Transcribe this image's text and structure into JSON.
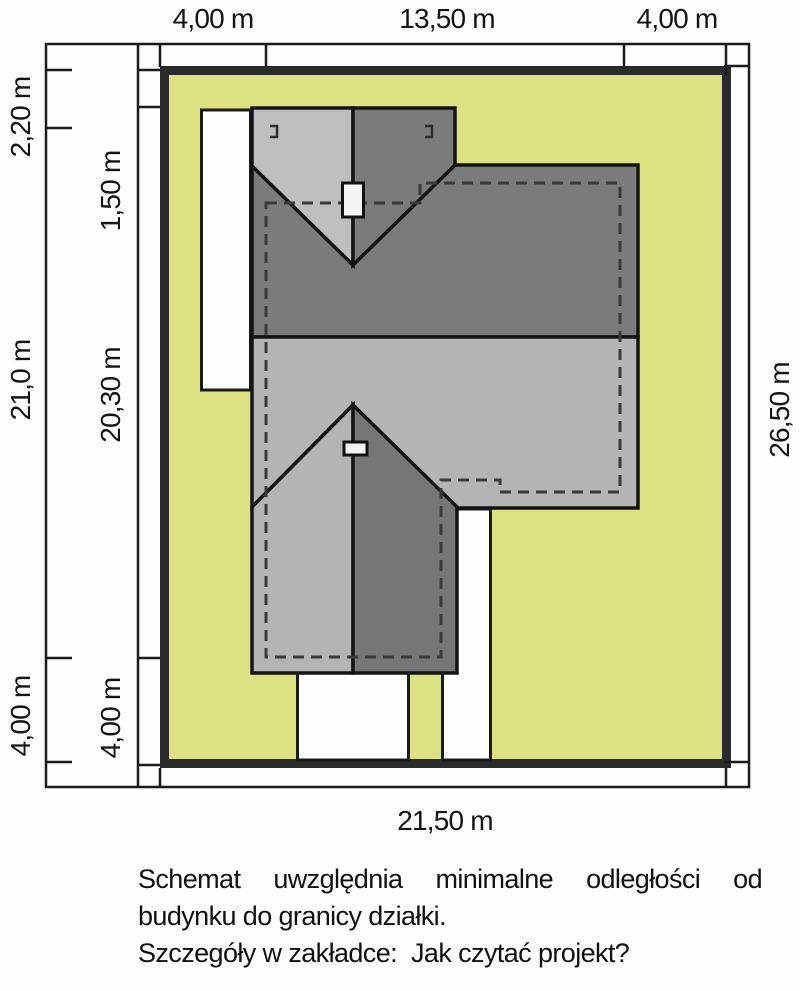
{
  "figure": {
    "type": "site-plan-schematic",
    "dimensions": {
      "top": [
        "4,00 m",
        "13,50 m",
        "4,00 m"
      ],
      "left_outer": [
        "2,20 m",
        "21,0 m",
        "4,00 m"
      ],
      "left_inner": [
        "1,50 m",
        "20,30 m",
        "4,00 m"
      ],
      "right": "26,50 m",
      "bottom": "21,50 m"
    },
    "note": {
      "line1": "Schemat uwzględnia minimalne odległości od",
      "line2": "budynku do granicy działki.",
      "line3_prefix": "Szczegóły w zakładce:",
      "line3_suffix": "Jak czytać projekt?"
    },
    "colors": {
      "plot_fill": "#dce181",
      "plot_border": "#2b2b2b",
      "roof_dark": "#7b7b7e",
      "roof_dark2": "#76767a",
      "roof_light": "#b4b4b6",
      "roof_light_wing": "#bfbfc1",
      "path_white": "#fdfdfc",
      "chimney_fill": "#f3f3f1",
      "line": "#1a1a1a"
    }
  }
}
